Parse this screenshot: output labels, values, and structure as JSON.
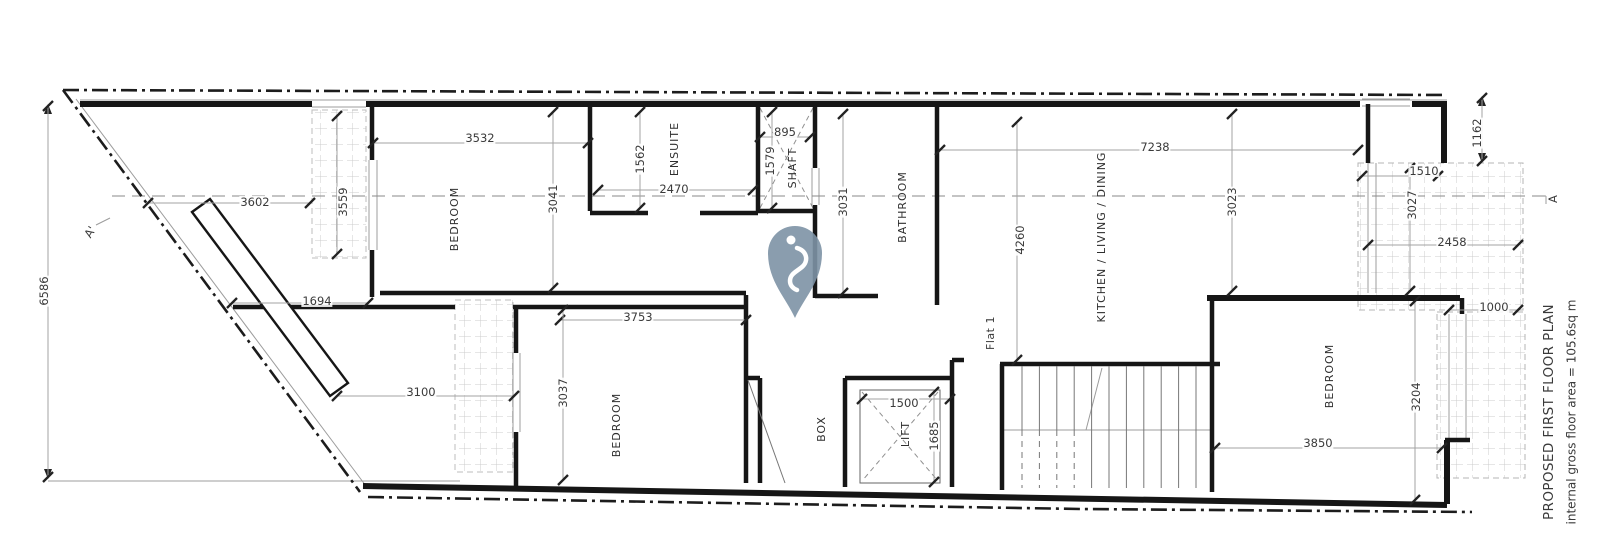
{
  "drawing": {
    "title": "PROPOSED FIRST FLOOR PLAN",
    "area_note": "internal gross floor area = 105.6sq m",
    "unit": "Flat 1",
    "section_markers": {
      "left": "A'",
      "right": "A"
    }
  },
  "rooms": {
    "bedroom_top": "BEDROOM",
    "ensuite": "ENSUITE",
    "shaft": "SHAFT",
    "bathroom": "BATHROOM",
    "kitchen": "KITCHEN / LIVING / DINING",
    "bedroom_left": "BEDROOM",
    "box": "BOX",
    "lift": "LIFT",
    "bedroom_right": "BEDROOM"
  },
  "dimensions": {
    "d6586": "6586",
    "d3602": "3602",
    "d3559": "3559",
    "d3532": "3532",
    "d3041": "3041",
    "d1562": "1562",
    "d2470": "2470",
    "d895": "895",
    "d1579": "1579",
    "d3031": "3031",
    "d7238": "7238",
    "d3023": "3023",
    "d4260": "4260",
    "d3027": "3027",
    "d1510": "1510",
    "d1162": "1162",
    "d2458": "2458",
    "d1000": "1000",
    "d1694": "1694",
    "d3753": "3753",
    "d3100": "3100",
    "d3037": "3037",
    "d1500": "1500",
    "d1685": "1685",
    "d3204": "3204",
    "d3850": "3850"
  },
  "colors": {
    "wall": "#161616",
    "dim_line": "#a3a3a3",
    "text": "#3a3a3a",
    "hatch": "#cccccc",
    "pin": "#7e93a6"
  }
}
